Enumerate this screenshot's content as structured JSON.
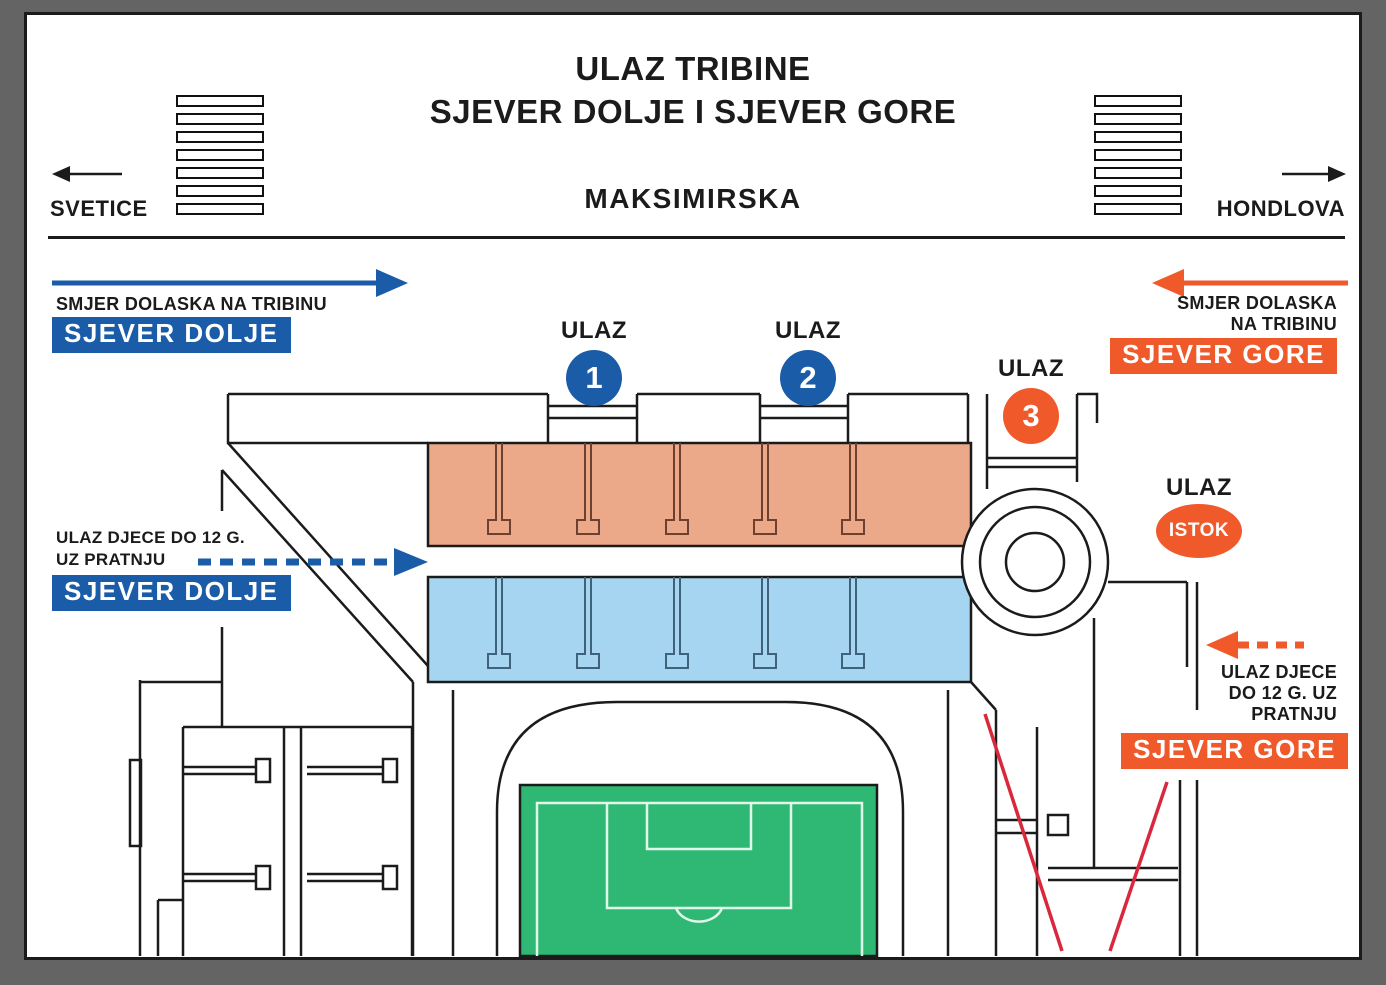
{
  "title": {
    "line1": "ULAZ TRIBINE",
    "line2": "SJEVER DOLJE I SJEVER GORE"
  },
  "street": {
    "name": "MAKSIMIRSKA",
    "left_destination": "SVETICE",
    "right_destination": "HONDLOVA"
  },
  "sjever_dolje": {
    "arrival_label": "SMJER DOLASKA NA TRIBINU",
    "arrival_badge": "SJEVER DOLJE",
    "children_line1": "ULAZ DJECE DO 12 G.",
    "children_line2": "UZ PRATNJU",
    "children_badge": "SJEVER DOLJE"
  },
  "sjever_gore": {
    "arrival_line1": "SMJER DOLASKA",
    "arrival_line2": "NA TRIBINU",
    "arrival_badge": "SJEVER GORE",
    "children_line1": "ULAZ DJECE",
    "children_line2": "DO 12 G. UZ",
    "children_line3": "PRATNJU",
    "children_badge": "SJEVER GORE"
  },
  "gates": {
    "gate1": {
      "label": "ULAZ",
      "number": "1"
    },
    "gate2": {
      "label": "ULAZ",
      "number": "2"
    },
    "gate3": {
      "label": "ULAZ",
      "number": "3"
    },
    "istok": {
      "label": "ULAZ",
      "name": "ISTOK"
    }
  },
  "colors": {
    "blue": "#1A5CA8",
    "orange": "#F05A2B",
    "salmon_stand": "#ECA98A",
    "light_blue_stand": "#A5D5F0",
    "pitch_green": "#2EB873",
    "route_red": "#D9283C",
    "line": "#1B1B1B"
  }
}
